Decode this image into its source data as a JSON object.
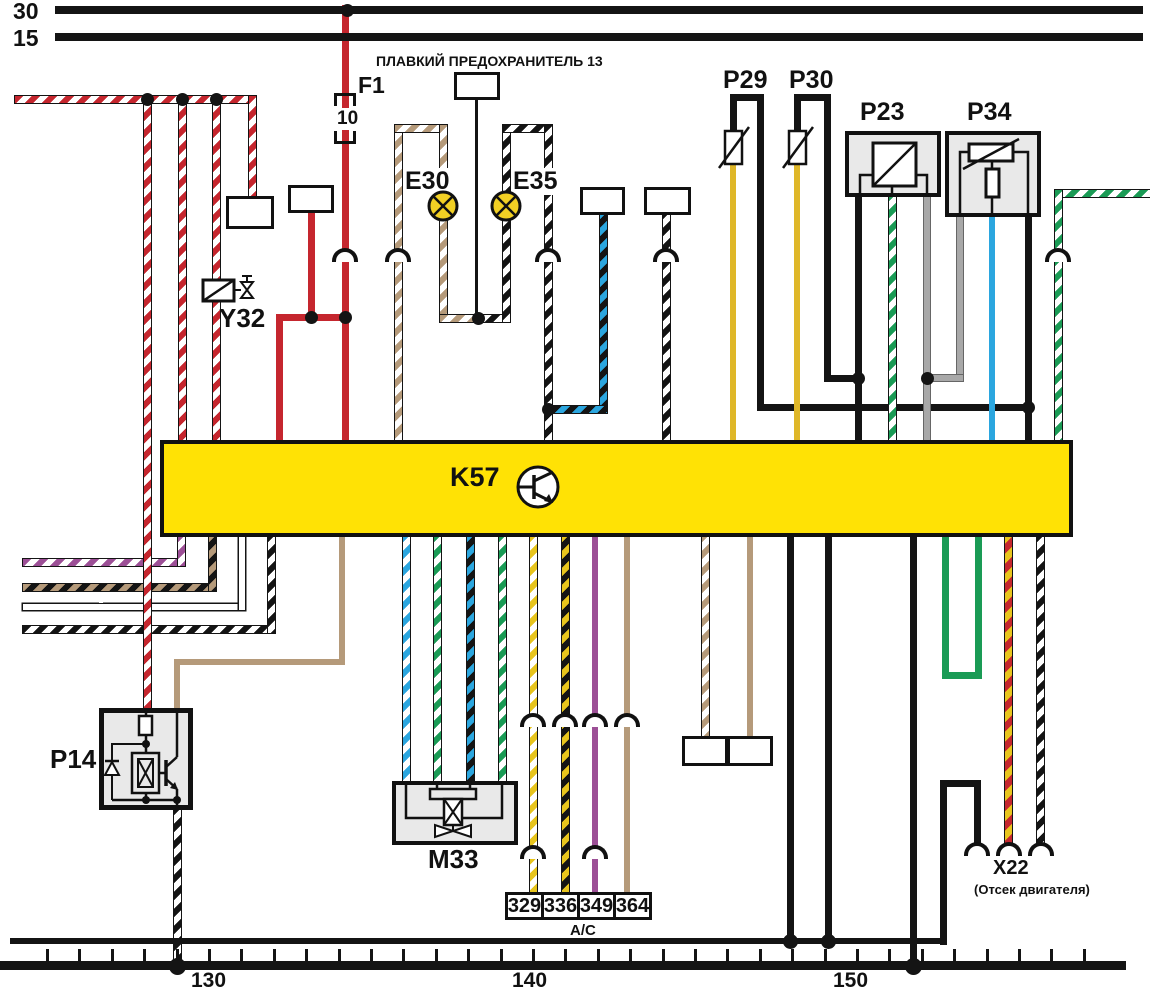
{
  "diagram": {
    "buses": {
      "b30": "30",
      "b15": "15"
    },
    "fuse_title": "ПЛАВКИЙ ПРЕДОХРАНИТЕЛЬ 13",
    "f1": {
      "label": "F1",
      "rating": "10"
    },
    "y32": "Y32",
    "e30": "E30",
    "e35": "E35",
    "p29": "P29",
    "p30": "P30",
    "p23": "P23",
    "p34": "P34",
    "k57": "K57",
    "p14": "P14",
    "m33": "M33",
    "x22": {
      "label": "X22",
      "note": "(Отсек двигателя)"
    },
    "ac_label": "А/С",
    "ac_boxes": [
      "329",
      "336",
      "349",
      "364"
    ],
    "scale": [
      "130",
      "140",
      "150"
    ]
  },
  "colors": {
    "k57_fill": "#ffe205",
    "red": "#c5262e",
    "tan": "#b59a7a",
    "yellow": "#dfb728",
    "bright_yellow": "#e8c51d",
    "blue": "#2ba6df",
    "green": "#1a9b55",
    "gray": "#a8a8a8",
    "purple": "#9c4f96",
    "black": "#141414",
    "lamp_yellow": "#f2d024",
    "box_gray": "#e9e9e9"
  },
  "code_boxes": [
    {
      "code": "264",
      "x": 454,
      "y": 72,
      "w": 46,
      "h": 28,
      "note": "",
      "npos": "none"
    },
    {
      "code": "384",
      "x": 288,
      "y": 185,
      "w": 46,
      "h": 28,
      "note": "ТСМ",
      "npos": "above"
    },
    {
      "code": "382",
      "x": 226,
      "y": 196,
      "w": 48,
      "h": 33,
      "note": "ТСМ",
      "npos": "below"
    },
    {
      "code": "377",
      "x": 580,
      "y": 187,
      "w": 45,
      "h": 28,
      "note": "ТСМ",
      "npos": "above"
    },
    {
      "code": "106",
      "x": 644,
      "y": 187,
      "w": 47,
      "h": 28,
      "note": "А/Т",
      "npos": "above"
    },
    {
      "code": "378",
      "x": 682,
      "y": 736,
      "w": 46,
      "h": 30,
      "note": "ТСМ",
      "npos": "below"
    },
    {
      "code": "376",
      "x": 727,
      "y": 736,
      "w": 46,
      "h": 30,
      "note": "ТСМ",
      "npos": "below"
    }
  ],
  "k57_pins": {
    "top": [
      {
        "label": "A6",
        "x": 168
      },
      {
        "label": "D16",
        "x": 197
      },
      {
        "label": "B1",
        "x": 271
      },
      {
        "label": "C16",
        "x": 329
      },
      {
        "label": "A5",
        "x": 389
      },
      {
        "label": "A2",
        "x": 538
      },
      {
        "label": "B10",
        "x": 652
      },
      {
        "label": "C12",
        "x": 715
      },
      {
        "label": "C10",
        "x": 780
      },
      {
        "label": "A11",
        "x": 843
      },
      {
        "label": "C11",
        "x": 876
      },
      {
        "label": "C14",
        "x": 909
      },
      {
        "label": "C13",
        "x": 972
      },
      {
        "label": "D2",
        "x": 1008
      },
      {
        "label": "A1",
        "x": 1041
      }
    ],
    "bottom": [
      {
        "label": "B6",
        "x": 170
      },
      {
        "label": "D5",
        "x": 199
      },
      {
        "label": "D4",
        "x": 230
      },
      {
        "label": "B3",
        "x": 260
      },
      {
        "label": "A10",
        "x": 328
      },
      {
        "label": "C5",
        "x": 393
      },
      {
        "label": "C4",
        "x": 424
      },
      {
        "label": "C6",
        "x": 459
      },
      {
        "label": "C3",
        "x": 489
      },
      {
        "label": "C1",
        "x": 521
      },
      {
        "label": "C9",
        "x": 554
      },
      {
        "label": "A4",
        "x": 582
      },
      {
        "label": "B8",
        "x": 612
      },
      {
        "label": "C2",
        "x": 692
      },
      {
        "label": "C7",
        "x": 736
      },
      {
        "label": "A12",
        "x": 774
      },
      {
        "label": "D7",
        "x": 814
      },
      {
        "label": "D6",
        "x": 898
      },
      {
        "label": "D9",
        "x": 931
      },
      {
        "label": "D10",
        "x": 960
      },
      {
        "label": "A8",
        "x": 996
      },
      {
        "label": "A9",
        "x": 1028
      }
    ]
  },
  "connectors": [
    {
      "name": "X4A",
      "pin": "3",
      "x": 345,
      "y": 248
    },
    {
      "name": "X4",
      "pin": "18",
      "x": 398,
      "y": 248
    },
    {
      "name": "X4",
      "pin": "11",
      "x": 548,
      "y": 248
    },
    {
      "name": "X4",
      "pin": "6",
      "x": 666,
      "y": 248
    },
    {
      "name": "X4",
      "pin": "7",
      "x": 1058,
      "y": 248
    },
    {
      "name": "X4A",
      "pin": "4",
      "x": 533,
      "y": 713
    },
    {
      "name": "X1",
      "pin": "2",
      "x": 565,
      "y": 713
    },
    {
      "name": "X4",
      "pin": "16",
      "x": 595,
      "y": 713
    },
    {
      "name": "X1",
      "pin": "1",
      "x": 627,
      "y": 713
    },
    {
      "name": "X7",
      "pin": "3",
      "x": 533,
      "y": 845
    },
    {
      "name": "X7",
      "pin": "10",
      "x": 595,
      "y": 845
    },
    {
      "name": "",
      "pin": "",
      "x": 977,
      "y": 842
    },
    {
      "name": "",
      "pin": "",
      "x": 1009,
      "y": 842
    },
    {
      "name": "",
      "pin": "",
      "x": 1041,
      "y": 842
    }
  ],
  "wire_labels": [
    {
      "t": "1,0",
      "x": 70,
      "y": 90
    },
    {
      "t": "0,75",
      "x": 129,
      "y": 236
    },
    {
      "t": "0,75",
      "x": 159,
      "y": 340
    },
    {
      "t": "0,75",
      "x": 202,
      "y": 151
    },
    {
      "t": "0,75",
      "x": 237,
      "y": 151
    },
    {
      "t": "0,75",
      "x": 295,
      "y": 246
    },
    {
      "t": "1,0",
      "x": 332,
      "y": 211
    },
    {
      "t": "1,0",
      "x": 265,
      "y": 367
    },
    {
      "t": "1,0",
      "x": 330,
      "y": 367
    },
    {
      "t": "0,5",
      "x": 387,
      "y": 207
    },
    {
      "t": "0,5",
      "x": 387,
      "y": 336
    },
    {
      "t": "0,5",
      "x": 537,
      "y": 207
    },
    {
      "t": "0,5",
      "x": 535,
      "y": 336
    },
    {
      "t": "0,5",
      "x": 589,
      "y": 336
    },
    {
      "t": "0,5",
      "x": 651,
      "y": 336
    },
    {
      "t": "0,75",
      "x": 747,
      "y": 309
    },
    {
      "t": "0,75",
      "x": 811,
      "y": 309
    },
    {
      "t": "0,75",
      "x": 712,
      "y": 367
    },
    {
      "t": "0,75",
      "x": 779,
      "y": 367
    },
    {
      "t": "0,75",
      "x": 844,
      "y": 337
    },
    {
      "t": "0,75",
      "x": 877,
      "y": 309
    },
    {
      "t": "0,75",
      "x": 907,
      "y": 337
    },
    {
      "t": "0,75",
      "x": 940,
      "y": 309
    },
    {
      "t": "0,75",
      "x": 977,
      "y": 337
    },
    {
      "t": "0,75",
      "x": 1008,
      "y": 309
    },
    {
      "t": "0,5",
      "x": 1097,
      "y": 184
    },
    {
      "t": "0,75",
      "x": 1037,
      "y": 336
    },
    {
      "t": "0,75",
      "x": 99,
      "y": 556
    },
    {
      "t": "0,75",
      "x": 99,
      "y": 581
    },
    {
      "t": "0,75",
      "x": 99,
      "y": 601
    },
    {
      "t": "0,75",
      "x": 99,
      "y": 623
    },
    {
      "t": "0,75",
      "x": 324,
      "y": 624
    },
    {
      "t": "0,75",
      "x": 388,
      "y": 595
    },
    {
      "t": "0,75",
      "x": 423,
      "y": 618
    },
    {
      "t": "0,75",
      "x": 453,
      "y": 595
    },
    {
      "t": "0,75",
      "x": 486,
      "y": 618
    },
    {
      "t": "0,75",
      "x": 517,
      "y": 595
    },
    {
      "t": "0,75",
      "x": 546,
      "y": 618
    },
    {
      "t": "0,75",
      "x": 577,
      "y": 595
    },
    {
      "t": "1,5",
      "x": 614,
      "y": 618
    },
    {
      "t": "0,5",
      "x": 688,
      "y": 595
    },
    {
      "t": "0,75",
      "x": 734,
      "y": 649
    },
    {
      "t": "0,75",
      "x": 896,
      "y": 722
    },
    {
      "t": "0,75",
      "x": 955,
      "y": 609
    },
    {
      "t": "0,75",
      "x": 991,
      "y": 695
    },
    {
      "t": "0,75",
      "x": 1023,
      "y": 728
    },
    {
      "t": "1,0",
      "x": 776,
      "y": 863
    },
    {
      "t": "1,0",
      "x": 814,
      "y": 863
    },
    {
      "t": "1,0",
      "x": 931,
      "y": 863
    },
    {
      "t": "0,75",
      "x": 158,
      "y": 865
    }
  ],
  "pin_labels": [
    {
      "t": "1",
      "x": 151,
      "y": 694
    },
    {
      "t": "2",
      "x": 183,
      "y": 694
    },
    {
      "t": "3",
      "x": 184,
      "y": 814
    },
    {
      "t": "C",
      "x": 411,
      "y": 765
    },
    {
      "t": "A",
      "x": 443,
      "y": 765
    },
    {
      "t": "D",
      "x": 478,
      "y": 765
    },
    {
      "t": "B",
      "x": 506,
      "y": 765
    },
    {
      "t": "A",
      "x": 979,
      "y": 824
    },
    {
      "t": "M",
      "x": 1017,
      "y": 824
    }
  ],
  "dots": [
    [
      347,
      10
    ],
    [
      147,
      99
    ],
    [
      182,
      99
    ],
    [
      216,
      99
    ],
    [
      311,
      317
    ],
    [
      345,
      317
    ],
    [
      478,
      318
    ],
    [
      548,
      409
    ],
    [
      858,
      378
    ],
    [
      927,
      378
    ],
    [
      1028,
      407
    ],
    [
      790,
      941,
      15
    ],
    [
      828,
      941,
      15
    ],
    [
      177,
      966,
      17
    ],
    [
      913,
      966,
      17
    ]
  ],
  "wires": [
    {
      "id": "fuse-f1-c16",
      "c": "red",
      "w": 7,
      "path": [
        [
          345,
          8
        ],
        [
          345,
          440
        ]
      ]
    },
    {
      "id": "branch-b1",
      "c": "red",
      "w": 7,
      "path": [
        [
          279,
          440
        ],
        [
          279,
          317
        ],
        [
          345,
          317
        ]
      ]
    },
    {
      "id": "tcm-384-feed",
      "c": "red",
      "w": 7,
      "path": [
        [
          311,
          213
        ],
        [
          311,
          317
        ]
      ]
    },
    {
      "id": "striped-feed",
      "c": "red-white",
      "w": 7,
      "path": [
        [
          18,
          99
        ],
        [
          252,
          99
        ],
        [
          252,
          196
        ]
      ]
    },
    {
      "id": "feed-a6",
      "c": "red-white",
      "w": 7,
      "path": [
        [
          182,
          99
        ],
        [
          182,
          440
        ]
      ]
    },
    {
      "id": "feed-d16-y32",
      "c": "red-white",
      "w": 7,
      "path": [
        [
          216,
          99
        ],
        [
          216,
          440
        ]
      ]
    },
    {
      "id": "out-b6",
      "c": "purple-white",
      "w": 7,
      "path": [
        [
          26,
          562
        ],
        [
          181,
          562
        ],
        [
          181,
          537
        ]
      ]
    },
    {
      "id": "out-d5",
      "c": "tan-black",
      "w": 7,
      "path": [
        [
          26,
          587
        ],
        [
          212,
          587
        ],
        [
          212,
          537
        ]
      ]
    },
    {
      "id": "out-d4",
      "c": "white",
      "w": 6,
      "path": [
        [
          26,
          607
        ],
        [
          242,
          607
        ],
        [
          242,
          537
        ]
      ]
    },
    {
      "id": "out-b3",
      "c": "black-white",
      "w": 7,
      "path": [
        [
          26,
          629
        ],
        [
          271,
          629
        ],
        [
          271,
          537
        ]
      ]
    },
    {
      "id": "feed-p14-1",
      "c": "red-white",
      "w": 7,
      "path": [
        [
          147,
          99
        ],
        [
          147,
          708
        ]
      ]
    },
    {
      "id": "fuse13-264",
      "c": "black",
      "w": 3,
      "path": [
        [
          476,
          99
        ],
        [
          476,
          318
        ]
      ]
    },
    {
      "id": "lamp-e30-loop",
      "c": "tan-white",
      "w": 7,
      "path": [
        [
          398,
          440
        ],
        [
          398,
          128
        ],
        [
          443,
          128
        ],
        [
          443,
          318
        ],
        [
          478,
          318
        ]
      ]
    },
    {
      "id": "lamp-e35-loop",
      "c": "black-white",
      "w": 7,
      "path": [
        [
          478,
          318
        ],
        [
          506,
          318
        ],
        [
          506,
          128
        ],
        [
          548,
          128
        ],
        [
          548,
          440
        ]
      ]
    },
    {
      "id": "tcm-377-sig",
      "c": "blue-black",
      "w": 7,
      "path": [
        [
          603,
          214
        ],
        [
          603,
          409
        ],
        [
          548,
          409
        ]
      ]
    },
    {
      "id": "at-106-b10",
      "c": "black-white",
      "w": 7,
      "path": [
        [
          666,
          214
        ],
        [
          666,
          440
        ]
      ]
    },
    {
      "id": "p29-c12",
      "c": "yellow",
      "w": 6,
      "path": [
        [
          733,
          164
        ],
        [
          733,
          440
        ]
      ]
    },
    {
      "id": "p29-black-d2",
      "c": "black",
      "w": 7,
      "path": [
        [
          733,
          132
        ],
        [
          733,
          97
        ],
        [
          760,
          97
        ],
        [
          760,
          407
        ],
        [
          1028,
          407
        ]
      ]
    },
    {
      "id": "p30-c10",
      "c": "yellow",
      "w": 6,
      "path": [
        [
          797,
          164
        ],
        [
          797,
          440
        ]
      ]
    },
    {
      "id": "p30-black-a11",
      "c": "black",
      "w": 7,
      "path": [
        [
          797,
          132
        ],
        [
          797,
          97
        ],
        [
          827,
          97
        ],
        [
          827,
          378
        ],
        [
          858,
          378
        ]
      ]
    },
    {
      "id": "p23-a11",
      "c": "black",
      "w": 7,
      "path": [
        [
          858,
          196
        ],
        [
          858,
          440
        ]
      ]
    },
    {
      "id": "p23-c11",
      "c": "green-white",
      "w": 7,
      "path": [
        [
          892,
          196
        ],
        [
          892,
          440
        ]
      ]
    },
    {
      "id": "p23-c14",
      "c": "gray",
      "w": 6,
      "path": [
        [
          927,
          196
        ],
        [
          927,
          440
        ]
      ]
    },
    {
      "id": "p34-gray",
      "c": "gray",
      "w": 6,
      "path": [
        [
          960,
          216
        ],
        [
          960,
          378
        ],
        [
          927,
          378
        ]
      ]
    },
    {
      "id": "p34-c13",
      "c": "blue",
      "w": 6,
      "path": [
        [
          992,
          216
        ],
        [
          992,
          440
        ]
      ]
    },
    {
      "id": "p34-black-d2",
      "c": "black",
      "w": 7,
      "path": [
        [
          1028,
          216
        ],
        [
          1028,
          440
        ]
      ]
    },
    {
      "id": "a1-feed",
      "c": "green-white",
      "w": 7,
      "path": [
        [
          1150,
          193
        ],
        [
          1058,
          193
        ],
        [
          1058,
          440
        ]
      ]
    },
    {
      "id": "a10-p14-2",
      "c": "tan",
      "w": 6,
      "path": [
        [
          342,
          537
        ],
        [
          342,
          662
        ],
        [
          177,
          662
        ],
        [
          177,
          708
        ]
      ]
    },
    {
      "id": "c5-m33",
      "c": "blue-white",
      "w": 7,
      "path": [
        [
          406,
          537
        ],
        [
          406,
          782
        ]
      ]
    },
    {
      "id": "c4-m33",
      "c": "green-white",
      "w": 7,
      "path": [
        [
          437,
          537
        ],
        [
          437,
          782
        ]
      ]
    },
    {
      "id": "c6-m33",
      "c": "blue-black",
      "w": 7,
      "path": [
        [
          470,
          537
        ],
        [
          470,
          782
        ]
      ]
    },
    {
      "id": "c3-m33",
      "c": "green-white",
      "w": 7,
      "path": [
        [
          502,
          537
        ],
        [
          502,
          782
        ]
      ]
    },
    {
      "id": "c1-329",
      "c": "yellow-white",
      "w": 7,
      "path": [
        [
          533,
          537
        ],
        [
          533,
          893
        ]
      ]
    },
    {
      "id": "c9-336",
      "c": "yellow-black",
      "w": 7,
      "path": [
        [
          565,
          537
        ],
        [
          565,
          893
        ]
      ]
    },
    {
      "id": "a4-349",
      "c": "purple",
      "w": 6,
      "path": [
        [
          595,
          537
        ],
        [
          595,
          893
        ]
      ]
    },
    {
      "id": "b8-364",
      "c": "tan",
      "w": 6,
      "path": [
        [
          627,
          537
        ],
        [
          627,
          893
        ]
      ]
    },
    {
      "id": "c2-378",
      "c": "tan-white",
      "w": 7,
      "path": [
        [
          705,
          537
        ],
        [
          705,
          738
        ]
      ]
    },
    {
      "id": "c7-376",
      "c": "tan",
      "w": 6,
      "path": [
        [
          750,
          537
        ],
        [
          750,
          738
        ]
      ]
    },
    {
      "id": "a12-gnd",
      "c": "black",
      "w": 7,
      "path": [
        [
          790,
          537
        ],
        [
          790,
          941
        ]
      ]
    },
    {
      "id": "d7-gnd",
      "c": "black",
      "w": 7,
      "path": [
        [
          828,
          537
        ],
        [
          828,
          941
        ]
      ]
    },
    {
      "id": "d6-gnd",
      "c": "black",
      "w": 7,
      "path": [
        [
          913,
          537
        ],
        [
          913,
          966
        ]
      ]
    },
    {
      "id": "d9-d10-jumper",
      "c": "green",
      "w": 7,
      "path": [
        [
          945,
          537
        ],
        [
          945,
          675
        ],
        [
          978,
          675
        ],
        [
          978,
          537
        ]
      ]
    },
    {
      "id": "a8-x22",
      "c": "yellow-red",
      "w": 7,
      "path": [
        [
          1008,
          537
        ],
        [
          1008,
          842
        ]
      ]
    },
    {
      "id": "a9-x22",
      "c": "black-white",
      "w": 7,
      "path": [
        [
          1040,
          537
        ],
        [
          1040,
          842
        ]
      ]
    },
    {
      "id": "x22-a-gnd",
      "c": "black",
      "w": 7,
      "path": [
        [
          943,
          941
        ],
        [
          943,
          783
        ],
        [
          977,
          783
        ],
        [
          977,
          842
        ]
      ]
    },
    {
      "id": "p14-3-gnd",
      "c": "black-white",
      "w": 7,
      "path": [
        [
          177,
          810
        ],
        [
          177,
          966
        ]
      ]
    }
  ]
}
